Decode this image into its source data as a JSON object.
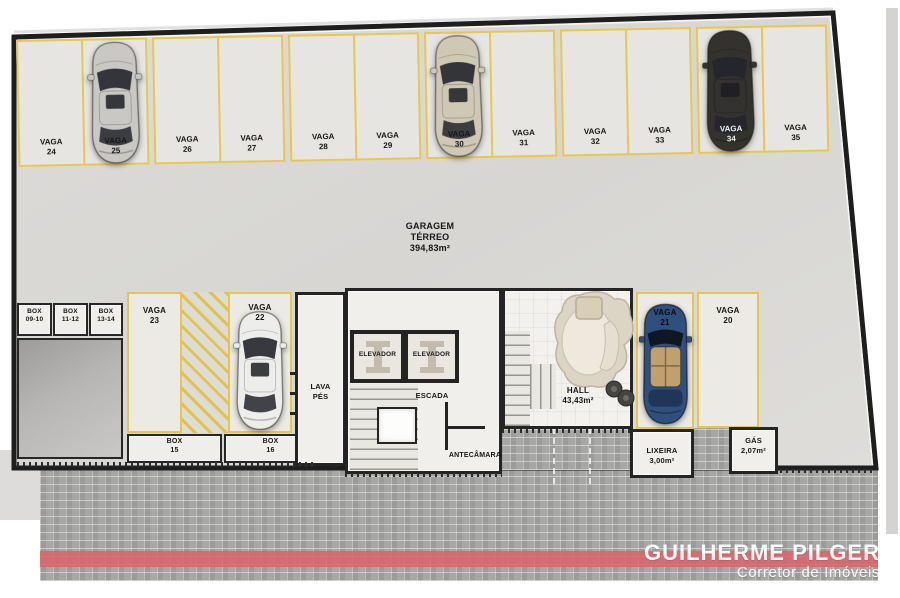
{
  "garage": {
    "title_line1": "GARAGEM",
    "title_line2": "TÉRREO",
    "title_line3": "394,83m²"
  },
  "top_row": [
    {
      "label": "VAGA",
      "num": "24"
    },
    {
      "label": "VAGA",
      "num": "25"
    },
    {
      "label": "VAGA",
      "num": "26"
    },
    {
      "label": "VAGA",
      "num": "27"
    },
    {
      "label": "VAGA",
      "num": "28"
    },
    {
      "label": "VAGA",
      "num": "29"
    },
    {
      "label": "VAGA",
      "num": "30"
    },
    {
      "label": "VAGA",
      "num": "31"
    },
    {
      "label": "VAGA",
      "num": "32"
    },
    {
      "label": "VAGA",
      "num": "33"
    },
    {
      "label": "VAGA",
      "num": "34"
    },
    {
      "label": "VAGA",
      "num": "35"
    }
  ],
  "small_boxes": [
    {
      "label": "BOX",
      "num": "09-10"
    },
    {
      "label": "BOX",
      "num": "11-12"
    },
    {
      "label": "BOX",
      "num": "13-14"
    }
  ],
  "big_boxes": [
    {
      "label": "BOX",
      "num": "15"
    },
    {
      "label": "BOX",
      "num": "16"
    }
  ],
  "lower_vagas": {
    "v23": {
      "label": "VAGA",
      "num": "23"
    },
    "v22": {
      "label": "VAGA",
      "num": "22"
    },
    "v21": {
      "label": "VAGA",
      "num": "21"
    },
    "v20": {
      "label": "VAGA",
      "num": "20"
    }
  },
  "rooms": {
    "lava_pes_line1": "LAVA",
    "lava_pes_line2": "PÉS",
    "elevador_1": "ELEVADOR",
    "elevador_2": "ELEVADOR",
    "escada": "ESCADA",
    "antecamara": "ANTECÂMARA",
    "hall_name": "HALL",
    "hall_area": "43,43m²",
    "lixeira_name": "LIXEIRA",
    "lixeira_area": "3,00m²",
    "gas_name": "GÁS",
    "gas_area": "2,07m²"
  },
  "cars": {
    "vaga25": {
      "color": "#c9c8c5",
      "type": "sedan-silver"
    },
    "vaga30": {
      "color": "#cfc8b5",
      "type": "suv-beige"
    },
    "vaga34": {
      "color": "#34322f",
      "type": "sedan-black"
    },
    "vaga22": {
      "color": "#ededeb",
      "type": "sedan-white"
    },
    "vaga21": {
      "color": "#2f4f7c",
      "interior": "#c2a06e",
      "type": "convertible-blue"
    }
  },
  "branding": {
    "name": "GUILHERME PILGER",
    "subtitle": "Corretor de Imóveis"
  },
  "colors": {
    "stall_line": "#e7c64f",
    "wall": "#1e1e1e",
    "floor": "#d9d8d5",
    "paver": "#a7a7a5",
    "red_stripe": "#db656a"
  }
}
